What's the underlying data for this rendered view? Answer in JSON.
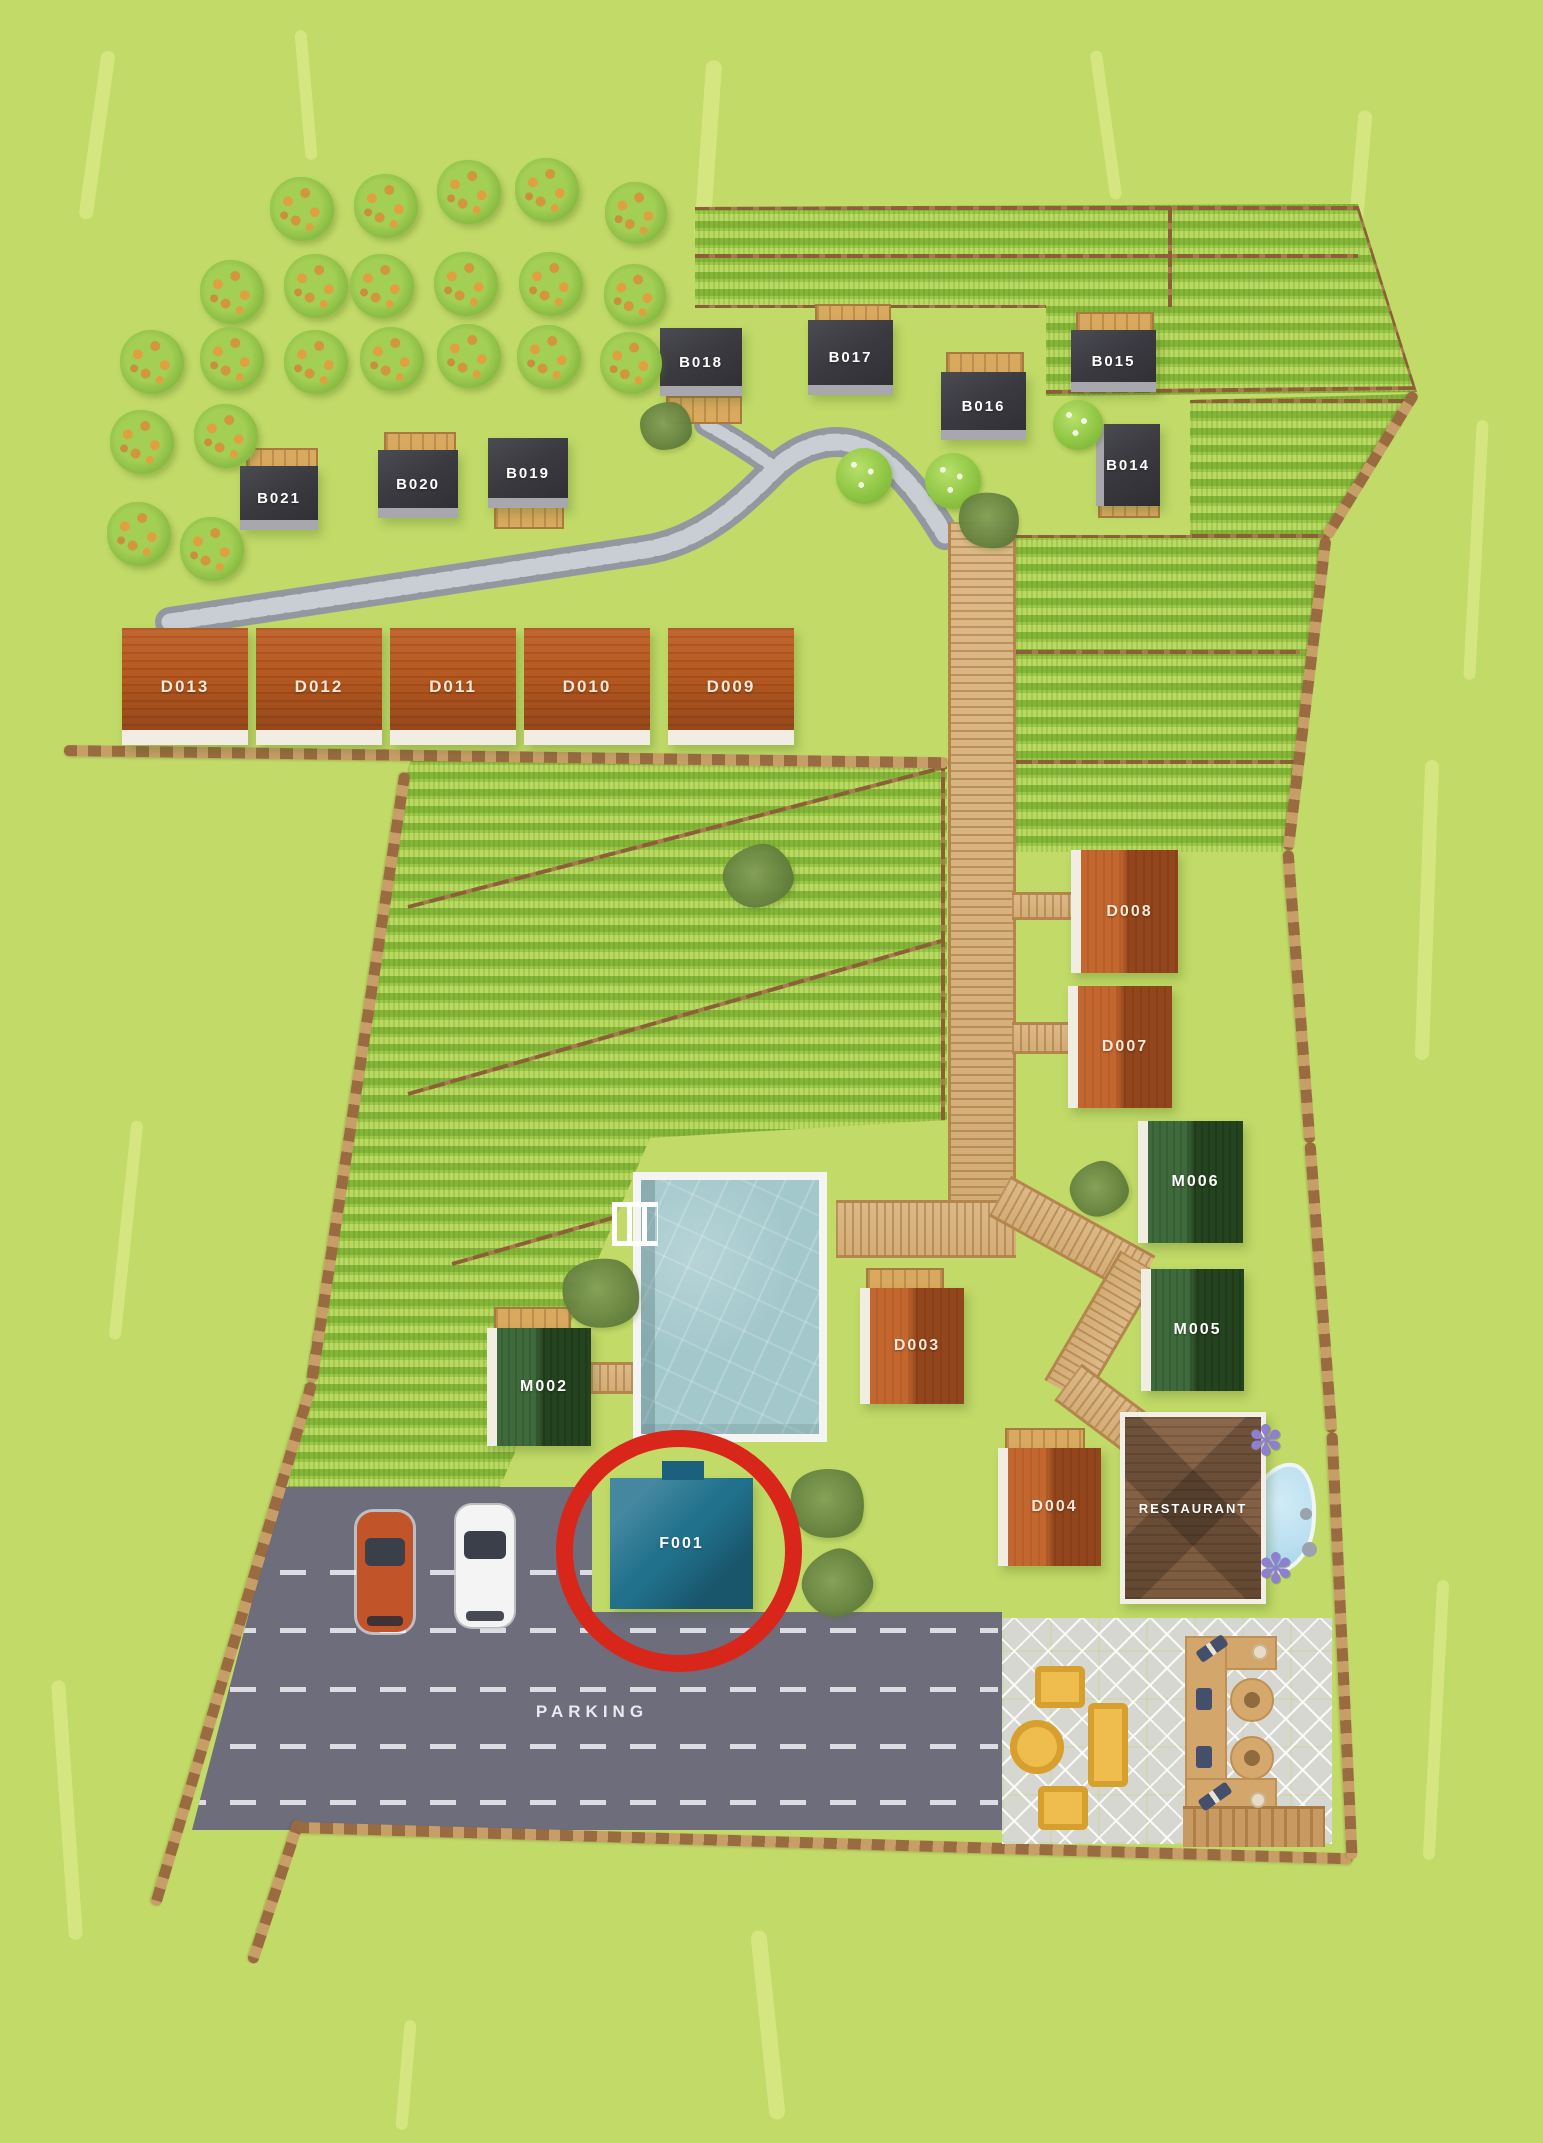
{
  "areas": {
    "parking_label": "PARKING"
  },
  "buildings": [
    {
      "id": "B014",
      "label": "B014",
      "roof": "dark"
    },
    {
      "id": "B015",
      "label": "B015",
      "roof": "dark"
    },
    {
      "id": "B016",
      "label": "B016",
      "roof": "dark"
    },
    {
      "id": "B017",
      "label": "B017",
      "roof": "dark"
    },
    {
      "id": "B018",
      "label": "B018",
      "roof": "dark"
    },
    {
      "id": "B019",
      "label": "B019",
      "roof": "dark"
    },
    {
      "id": "B020",
      "label": "B020",
      "roof": "dark"
    },
    {
      "id": "B021",
      "label": "B021",
      "roof": "dark"
    },
    {
      "id": "D003",
      "label": "D003",
      "roof": "red"
    },
    {
      "id": "D004",
      "label": "D004",
      "roof": "red"
    },
    {
      "id": "D007",
      "label": "D007",
      "roof": "red"
    },
    {
      "id": "D008",
      "label": "D008",
      "roof": "red"
    },
    {
      "id": "D009",
      "label": "D009",
      "roof": "red"
    },
    {
      "id": "D010",
      "label": "D010",
      "roof": "red"
    },
    {
      "id": "D011",
      "label": "D011",
      "roof": "red"
    },
    {
      "id": "D012",
      "label": "D012",
      "roof": "red"
    },
    {
      "id": "D013",
      "label": "D013",
      "roof": "red"
    },
    {
      "id": "M002",
      "label": "M002",
      "roof": "green"
    },
    {
      "id": "M005",
      "label": "M005",
      "roof": "green"
    },
    {
      "id": "M006",
      "label": "M006",
      "roof": "green"
    },
    {
      "id": "F001",
      "label": "F001",
      "roof": "teal"
    },
    {
      "id": "RESTAURANT",
      "label": "RESTAURANT",
      "roof": "brown"
    }
  ],
  "highlight": {
    "shape": "circle",
    "around": "F001",
    "color": "#d8261a"
  },
  "vehicles": [
    {
      "name": "orange-car",
      "color": "#c2542a"
    },
    {
      "name": "white-car",
      "color": "#f4f4f4"
    }
  ],
  "landscape": {
    "orchard_trees": 22,
    "pool": true,
    "pond": true,
    "vineyard_fields": 3,
    "parking_lanes": 5
  },
  "colors": {
    "grass": "#c1da68",
    "field_rows": "#8abb3a",
    "parking": "#6d6d7c",
    "patio": "#d7d7d2",
    "pool_water": "#a3c8cc",
    "pond_water": "#badff0",
    "deck_wood": "#d8a95f",
    "boardwalk": "#d9b583",
    "stone_path": "#9298a0",
    "boundary_fence": "#9a6a40",
    "roof_dark": "#3a3a40",
    "roof_red": "#b3571f",
    "roof_green": "#2f5230",
    "roof_teal": "#21718d",
    "roof_restaurant": "#826044",
    "highlight_red": "#d8261a",
    "furniture_yellow": "#eebd4e",
    "furniture_tan": "#d3a76b"
  }
}
